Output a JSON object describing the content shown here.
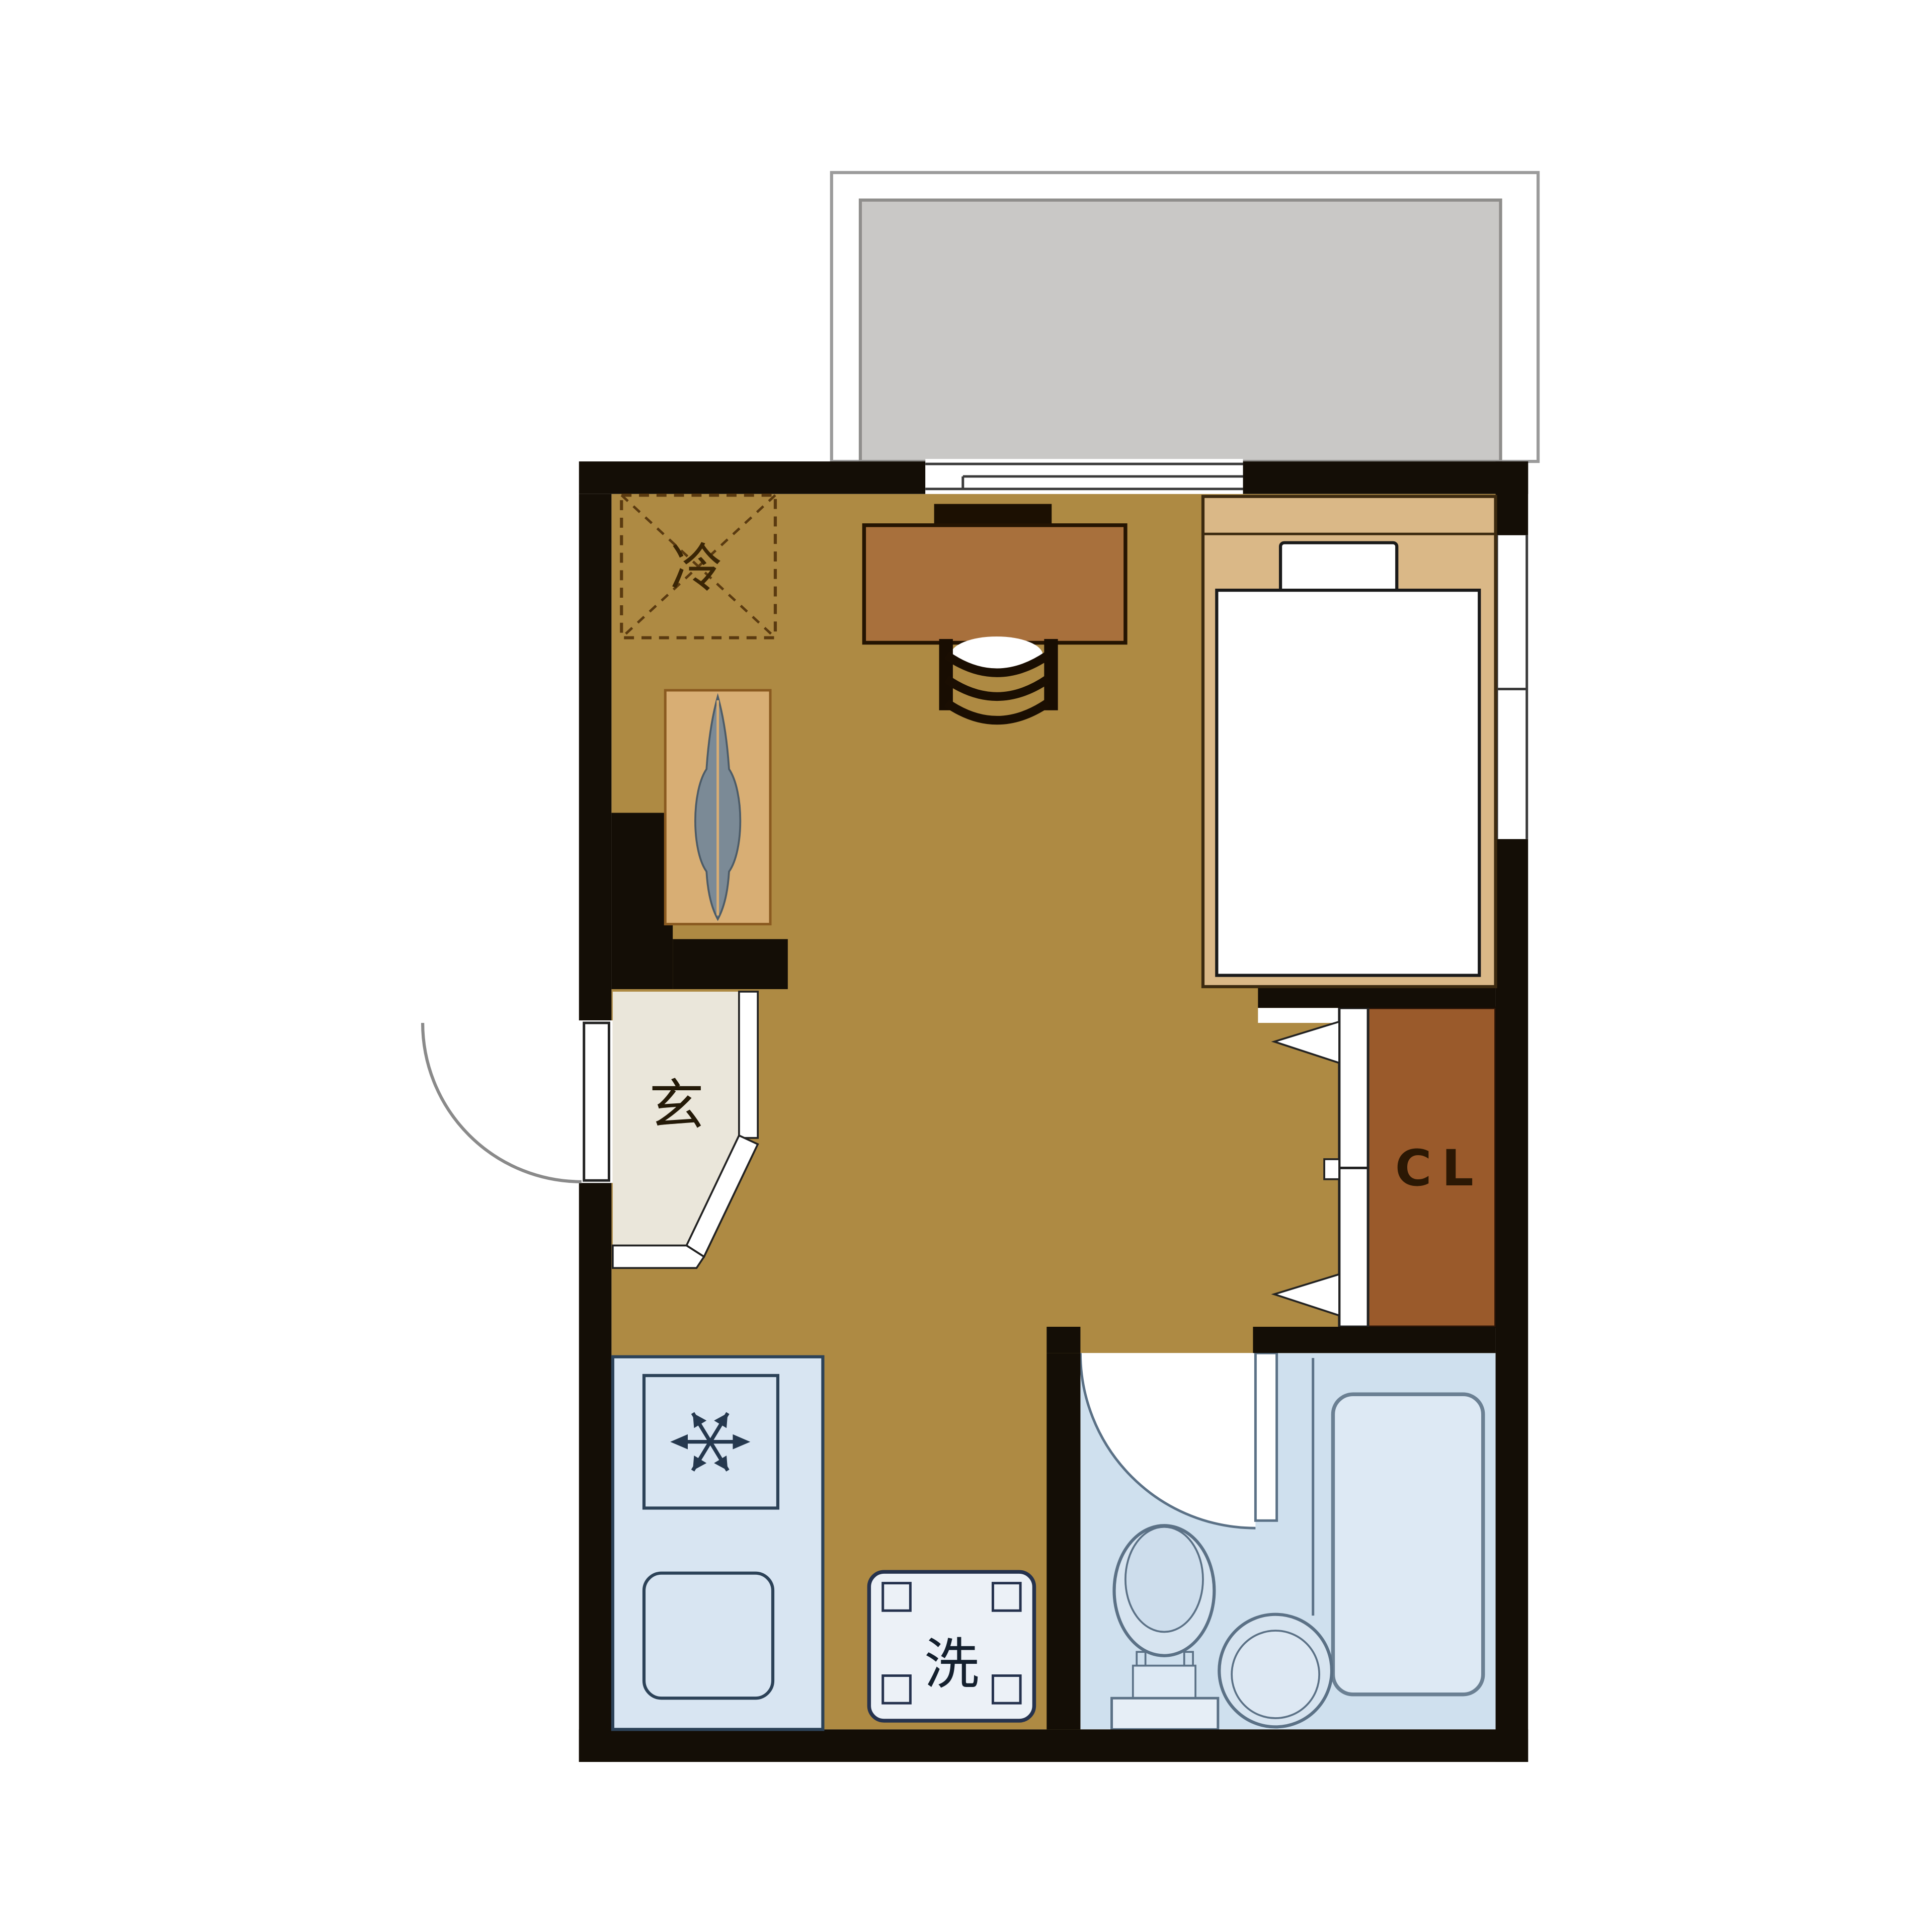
{
  "plan": {
    "title": "studio apartment floor plan",
    "labels": {
      "refrigerator": "冷",
      "entrance": "玄",
      "closet": "CL",
      "washer": "洗"
    },
    "colors": {
      "wall": "#140E06",
      "floor": "#AE8A43",
      "balcony_floor": "#C9C8C6",
      "balcony_outline": "#9B9B9B",
      "genkan_floor": "#EAE6DA",
      "closet_interior": "#9A5A2B",
      "bed_frame": "#DAB887",
      "desk": "#A8703C",
      "monitor": "#1C1002",
      "kitchen_fill": "#D8E5F2",
      "kitchen_stroke": "#2C4258",
      "bathroom_fill": "#CFE0EE",
      "fixture_fill": "#DDE9F4",
      "fixture_stroke": "#5B7186",
      "washer_fill": "#ECF1F7",
      "washer_stroke": "#25324E",
      "mat": "#D8AE74",
      "skis": "#7B8A96",
      "fridge_dash": "#5A3A10"
    },
    "icons": {
      "stove-burner-icon": "six-spoke star",
      "door-swing-icon": "quarter-circle arc",
      "closet-fold-door-icon": "white strip with two arrows",
      "window-icon": "white break in wall with sash lines"
    }
  }
}
